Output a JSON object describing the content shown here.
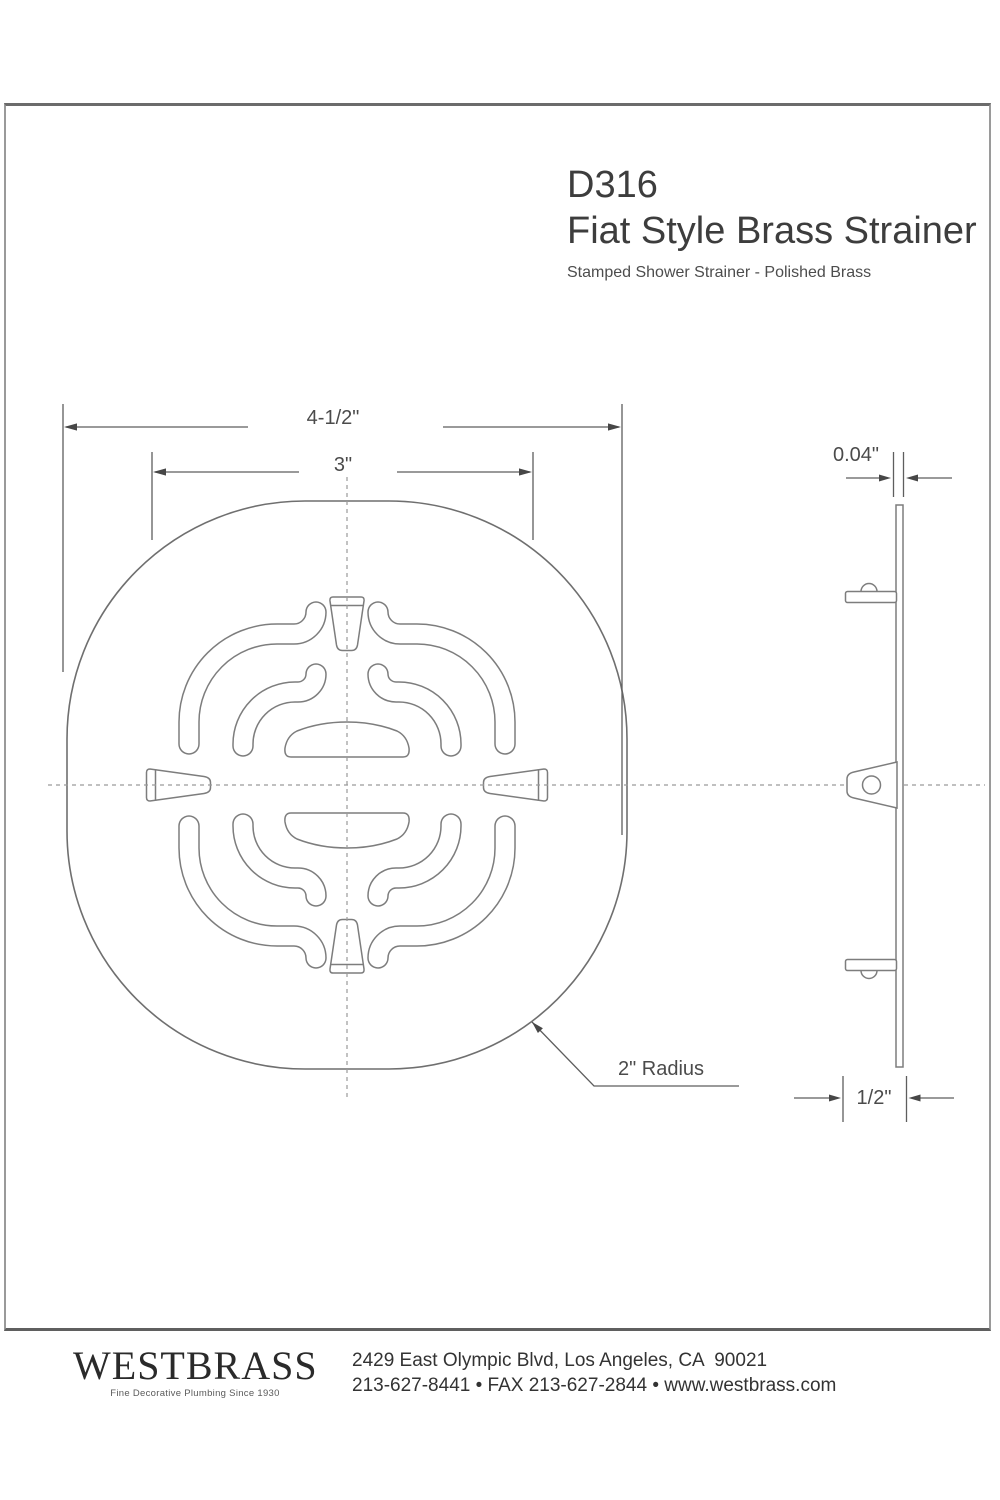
{
  "title_block": {
    "model": "D316",
    "product_name": "Fiat Style Brass Strainer",
    "subtitle": "Stamped Shower Strainer - Polished Brass"
  },
  "dimensions": {
    "overall_width": "4-1/2\"",
    "inner_width": "3\"",
    "thickness": "0.04\"",
    "depth": "1/2\"",
    "corner_radius": "2\" Radius"
  },
  "footer": {
    "brand": "WESTBRASS",
    "tagline": "Fine Decorative Plumbing Since 1930",
    "address": "2429 East Olympic Blvd, Los Angeles, CA  90021",
    "phone_line": "213-627-8441 • FAX 213-627-2844 • www.westbrass.com"
  },
  "colors": {
    "line": "#7d7d7d",
    "dimension": "#5e5e5e",
    "text": "#3d3d3d"
  }
}
